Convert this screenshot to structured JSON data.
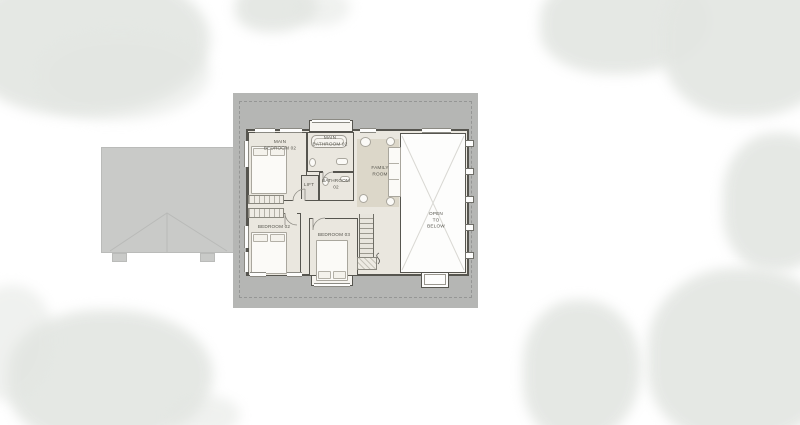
{
  "plan": {
    "type": "floor-plan",
    "rooms": {
      "main_bedroom_02": {
        "label": "MAIN\nBEDROOM 02"
      },
      "main_bathroom_02": {
        "label": "MAIN\nBATHROOM 02"
      },
      "bathroom_02": {
        "label": "BATHROOM 02"
      },
      "lift": {
        "label": "LIFT"
      },
      "family_room": {
        "label": "FAMILY\nROOM"
      },
      "bedroom_02": {
        "label": "BEDROOM 02"
      },
      "bedroom_03": {
        "label": "BEDROOM 03"
      },
      "open_to_below": {
        "label": "OPEN\nTO\nBELOW"
      }
    }
  },
  "colors": {
    "roof-band": "#b5b6b4",
    "garage-roof": "#c9cac8",
    "floor": "#eae7df",
    "rug": "#dcd7c9",
    "wall": "#56554f",
    "open-floor": "#fdfdfc",
    "tree": "#e3e6e2",
    "label-text": "#55544c"
  }
}
